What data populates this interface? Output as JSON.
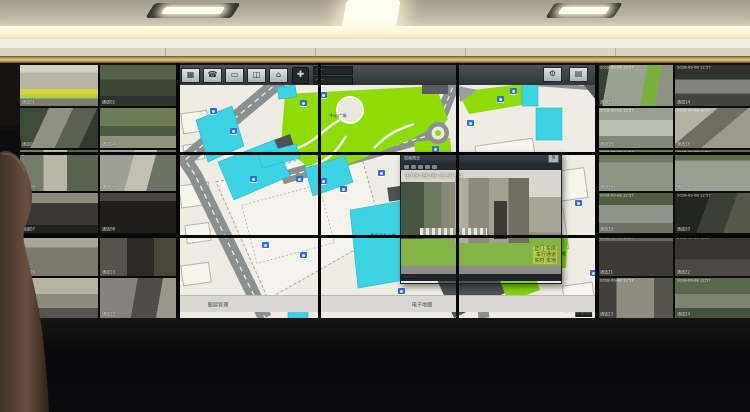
{
  "scene_description": "Photo of a security control-room video wall: left and right banks of CCTV camera tiles, centre 3x3 monitor array showing a campus GIS map with a live-video popup window",
  "ceiling": {
    "fixtures": 3
  },
  "left_wall": {
    "feeds": [
      {
        "scene": "sc-l1",
        "label": "通道01"
      },
      {
        "scene": "sc-l2",
        "label": "通道02"
      },
      {
        "scene": "sc-l3",
        "label": "通道03"
      },
      {
        "scene": "sc-l4",
        "label": "通道04"
      },
      {
        "scene": "sc-l5",
        "label": "通道05"
      },
      {
        "scene": "sc-l6",
        "label": "通道06"
      },
      {
        "scene": "sc-l7",
        "label": "通道07"
      },
      {
        "scene": "sc-l8",
        "label": "通道08"
      },
      {
        "scene": "sc-l9",
        "label": "通道09"
      },
      {
        "scene": "sc-l10",
        "label": "通道10"
      },
      {
        "scene": "sc-l11",
        "label": "通道11"
      },
      {
        "scene": "sc-l12",
        "label": "通道12"
      }
    ]
  },
  "right_wall": {
    "osd_time": "2018-09-08 12:57",
    "feeds": [
      {
        "scene": "sc-r1",
        "label": "通道13"
      },
      {
        "scene": "sc-r2",
        "label": "通道14"
      },
      {
        "scene": "sc-r3",
        "label": "通道15"
      },
      {
        "scene": "sc-r4",
        "label": "通道16"
      },
      {
        "scene": "sc-r5",
        "label": "通道17"
      },
      {
        "scene": "sc-r6",
        "label": "通道18"
      },
      {
        "scene": "sc-r7",
        "label": "通道19"
      },
      {
        "scene": "sc-r8",
        "label": "通道20"
      },
      {
        "scene": "sc-r9",
        "label": "通道21"
      },
      {
        "scene": "sc-r10",
        "label": "通道22"
      },
      {
        "scene": "sc-r11",
        "label": "通道23"
      },
      {
        "scene": "sc-r12",
        "label": "通道24"
      }
    ]
  },
  "map_screen": {
    "toolbar": {
      "buttons": [
        {
          "name": "monitor-button",
          "glyph": "▦"
        },
        {
          "name": "phone-button",
          "glyph": "☎"
        },
        {
          "name": "display-button",
          "glyph": "▭"
        },
        {
          "name": "door-button",
          "glyph": "◫"
        },
        {
          "name": "person-button",
          "glyph": "⌂"
        }
      ],
      "dpad_glyph": "✚",
      "readouts": [
        "·····",
        "·····"
      ],
      "right_buttons": [
        {
          "name": "gear-button",
          "glyph": "⚙"
        },
        {
          "name": "layers-button",
          "glyph": "▤"
        }
      ]
    },
    "tabs": {
      "left": "图层管理",
      "center": "电子地图"
    },
    "status_text": "·· ··· ····",
    "colors": {
      "lawn": "#8fdc05",
      "building_cyan": "#3ed3e3",
      "road": "#8b9091",
      "background": "#eeece3",
      "dark_block": "#4e5254"
    },
    "labels": [
      {
        "text": "中心广场",
        "x": 150,
        "y": 30
      },
      {
        "text": "委员会办公楼",
        "x": 190,
        "y": 150
      },
      {
        "text": "文体活动中心",
        "x": 238,
        "y": 188
      },
      {
        "text": "小区",
        "x": 30,
        "y": 214
      },
      {
        "text": "综合楼",
        "x": 374,
        "y": 168
      }
    ],
    "cameras": [
      {
        "x": 32,
        "y": 24
      },
      {
        "x": 52,
        "y": 44
      },
      {
        "x": 72,
        "y": 92
      },
      {
        "x": 118,
        "y": 92
      },
      {
        "x": 142,
        "y": 94
      },
      {
        "x": 162,
        "y": 102
      },
      {
        "x": 200,
        "y": 86
      },
      {
        "x": 228,
        "y": 86
      },
      {
        "x": 254,
        "y": 62
      },
      {
        "x": 289,
        "y": 36
      },
      {
        "x": 319,
        "y": 12
      },
      {
        "x": 332,
        "y": 4
      },
      {
        "x": 122,
        "y": 16
      },
      {
        "x": 142,
        "y": 8
      },
      {
        "x": 84,
        "y": 158
      },
      {
        "x": 122,
        "y": 168
      },
      {
        "x": 184,
        "y": 216
      },
      {
        "x": 220,
        "y": 204
      },
      {
        "x": 397,
        "y": 116
      },
      {
        "x": 412,
        "y": 186
      }
    ]
  },
  "popup": {
    "title": "视频预览",
    "close_glyph": "×",
    "timestamp": "2018-09-08 12:57:04",
    "osd_lines": [
      "正门 东侧",
      "车行通道",
      "实时 本地"
    ],
    "bottom_text": "·· ···· ··"
  }
}
